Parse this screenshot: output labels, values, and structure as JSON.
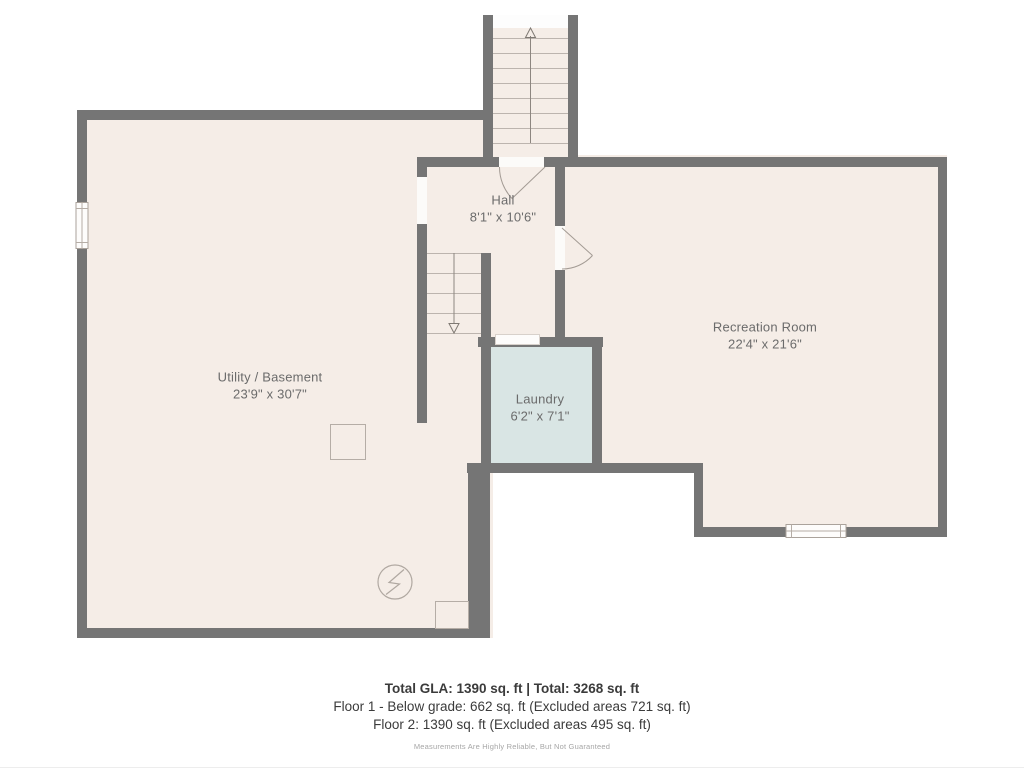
{
  "colors": {
    "wall": "#757575",
    "floor": "#f5ede7",
    "laundry": "#d9e5e4",
    "opening": "#fcfbf9",
    "line": "#bcb4ae",
    "door": "#a39b94",
    "label": "#6b6b6b",
    "footer": "#3b3b3b",
    "disclaimer": "#a6a6a6"
  },
  "rooms": {
    "utility": {
      "name": "Utility / Basement",
      "dims": "23'9\" x 30'7\""
    },
    "hall": {
      "name": "Hall",
      "dims": "8'1\" x 10'6\""
    },
    "recreation": {
      "name": "Recreation Room",
      "dims": "22'4\" x 21'6\""
    },
    "laundry": {
      "name": "Laundry",
      "dims": "6'2\" x 7'1\""
    }
  },
  "footer": {
    "totals": "Total GLA: 1390 sq. ft | Total: 3268 sq. ft",
    "floor1": "Floor 1 - Below grade: 662 sq. ft (Excluded areas 721 sq. ft)",
    "floor2": "Floor 2: 1390 sq. ft (Excluded areas 495 sq. ft)",
    "disclaimer": "Measurements Are Highly Reliable, But Not Guaranteed"
  }
}
